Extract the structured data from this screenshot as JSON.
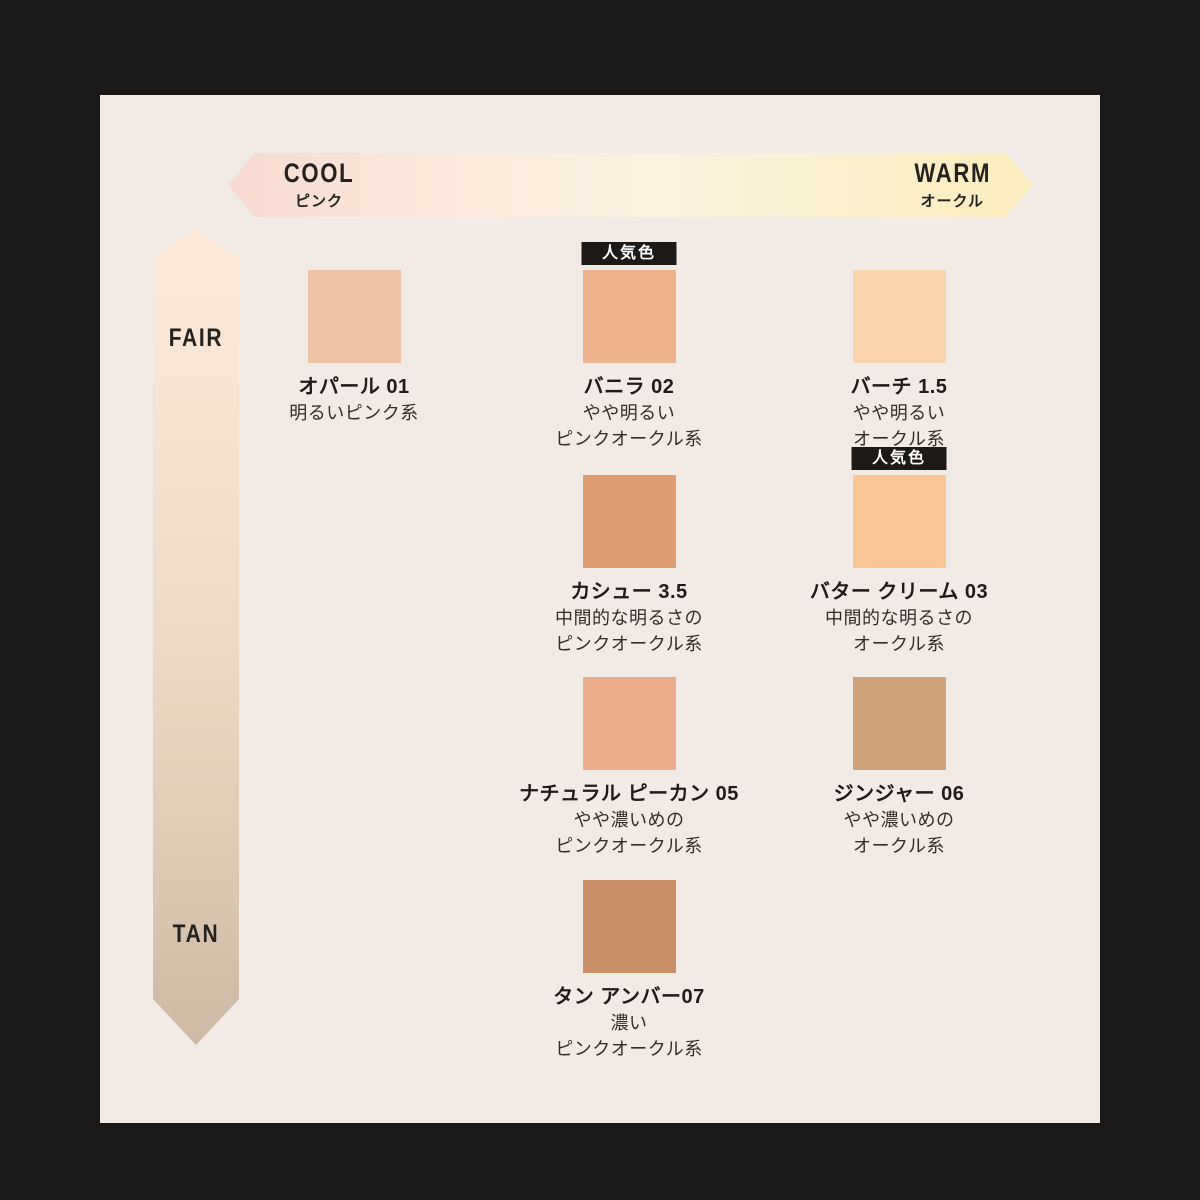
{
  "panel": {
    "background": "#f1eae5",
    "frame_color": "#1b1a18"
  },
  "axes": {
    "horizontal": {
      "left_label": "COOL",
      "left_sublabel": "ピンク",
      "right_label": "WARM",
      "right_sublabel": "オークル",
      "gradient": [
        "#f8dbd3",
        "#fbf2e2",
        "#f9ecbe"
      ]
    },
    "vertical": {
      "top_label": "FAIR",
      "bottom_label": "TAN",
      "gradient": [
        "#fae9da",
        "#eddbc7",
        "#ccbaa5"
      ]
    }
  },
  "labels": {
    "popular_badge": "人気色"
  },
  "shades": [
    {
      "name": "オパール 01",
      "desc": [
        "明るいピンク系"
      ],
      "color": "#eec2a4",
      "popular": false,
      "row": 1,
      "column": 1
    },
    {
      "name": "バニラ 02",
      "desc": [
        "やや明るい",
        "ピンクオークル系"
      ],
      "color": "#eeb28c",
      "popular": true,
      "row": 1,
      "column": 2
    },
    {
      "name": "バーチ 1.5",
      "desc": [
        "やや明るい",
        "オークル系"
      ],
      "color": "#f9d4ae",
      "popular": false,
      "row": 1,
      "column": 3
    },
    {
      "name": "カシュー 3.5",
      "desc": [
        "中間的な明るさの",
        "ピンクオークル系"
      ],
      "color": "#dd9c72",
      "popular": false,
      "row": 2,
      "column": 2
    },
    {
      "name": "バター クリーム 03",
      "desc": [
        "中間的な明るさの",
        "オークル系"
      ],
      "color": "#fbc697",
      "popular": true,
      "row": 2,
      "column": 3
    },
    {
      "name": "ナチュラル ピーカン 05",
      "desc": [
        "やや濃いめの",
        "ピンクオークル系"
      ],
      "color": "#eaac8b",
      "popular": false,
      "row": 3,
      "column": 2
    },
    {
      "name": "ジンジャー 06",
      "desc": [
        "やや濃いめの",
        "オークル系"
      ],
      "color": "#cfa379",
      "popular": false,
      "row": 3,
      "column": 3
    },
    {
      "name": "タン アンバー07",
      "desc": [
        "濃い",
        "ピンクオークル系"
      ],
      "color": "#c98f68",
      "popular": false,
      "row": 4,
      "column": 2
    }
  ]
}
